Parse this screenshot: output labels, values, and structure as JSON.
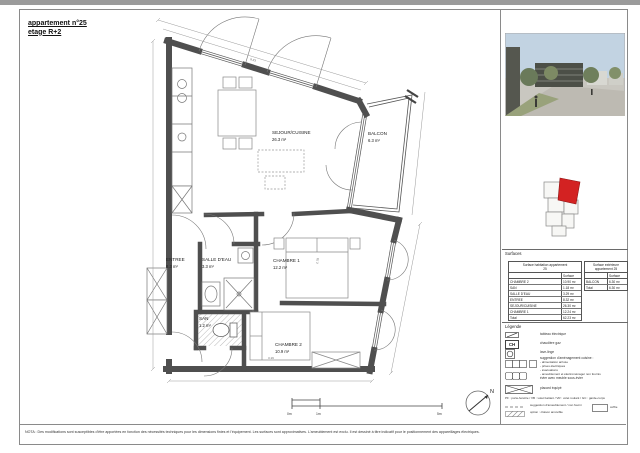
{
  "title": {
    "line1": "appartement n°25",
    "line2": "etage R+2"
  },
  "plan": {
    "rooms": [
      {
        "name": "SEJOUR/CUISINE",
        "area": "26.3 m²"
      },
      {
        "name": "BALCON",
        "area": "6.3 m²"
      },
      {
        "name": "ENTREE",
        "area": "8.3 m²"
      },
      {
        "name": "SALLE D'EAU",
        "area": "3.3 m²"
      },
      {
        "name": "CHAMBRE 1",
        "area": "12.2 m²"
      },
      {
        "name": "SAN",
        "area": "1.2 m²"
      },
      {
        "name": "CHAMBRE 2",
        "area": "10.9 m²"
      }
    ],
    "dimensions": {
      "top": "8.33",
      "chambre1": "2.78",
      "chambre2": "3.19"
    },
    "compass_label": "N",
    "scale": {
      "start": "0m",
      "mid": "1m",
      "end": "5m"
    }
  },
  "sidebar": {
    "surfaces_heading": "Surfaces",
    "legende_heading": "Légende",
    "table_habitable": {
      "title": "Surface habitation appartement",
      "title2": "25",
      "col": "Surface",
      "rows": [
        {
          "label": "CHAMBRE 2",
          "value": "10.90 m²"
        },
        {
          "label": "SAN",
          "value": "1.18 m²"
        },
        {
          "label": "SALLE D'EAU",
          "value": "3.29 m²"
        },
        {
          "label": "ENTREE",
          "value": "8.32 m²"
        },
        {
          "label": "SEJOUR/CUISINE",
          "value": "26.30 m²"
        },
        {
          "label": "CHAMBRE 1",
          "value": "12.24 m²"
        }
      ],
      "total_label": "Total",
      "total_value": "62.23 m²"
    },
    "table_exterieure": {
      "title": "Surface extérieure",
      "title2": "appartement 25",
      "col": "Surface",
      "rows": [
        {
          "label": "BALCON",
          "value": "6.30 m²"
        }
      ],
      "total_label": "Total",
      "total_value": "6.30 m²"
    },
    "legend": {
      "items": [
        {
          "label": "tableau électrique"
        },
        {
          "label": "chaudière gaz"
        },
        {
          "label": "lave-linge"
        },
        {
          "label": "suggestion d'aménagement cuisine :",
          "sub": [
            "- alimentation arrivée",
            "- prises électriques",
            "- évacuations",
            "- ameublement et électroménager non fournis"
          ]
        },
        {
          "label": "évier avec meuble sous-évier"
        },
        {
          "label": "placard équipé"
        }
      ],
      "ch_symbol": "CH",
      "abbreviations": "PF : porte-fenêtre / VB : volet battant / VR : volet roulant / GC : garde-corps",
      "suggestion_line": "suggestion d'ameublement / non fourni",
      "option_line": "option : cloison amovible",
      "coffre_label": "coffre"
    }
  },
  "footer": {
    "nota": "NOTA : Des modifications sont susceptibles d'être apportées en fonction des nécessités techniques pour les dimensions finies et l'équipement. Les surfaces sont approximatives. L'ameublement est exclu. Il est dessiné à titre indicatif pour le positionnement des appareillages électriques."
  },
  "colors": {
    "wall": "#4f4f4f",
    "highlight_red": "#d32222"
  }
}
